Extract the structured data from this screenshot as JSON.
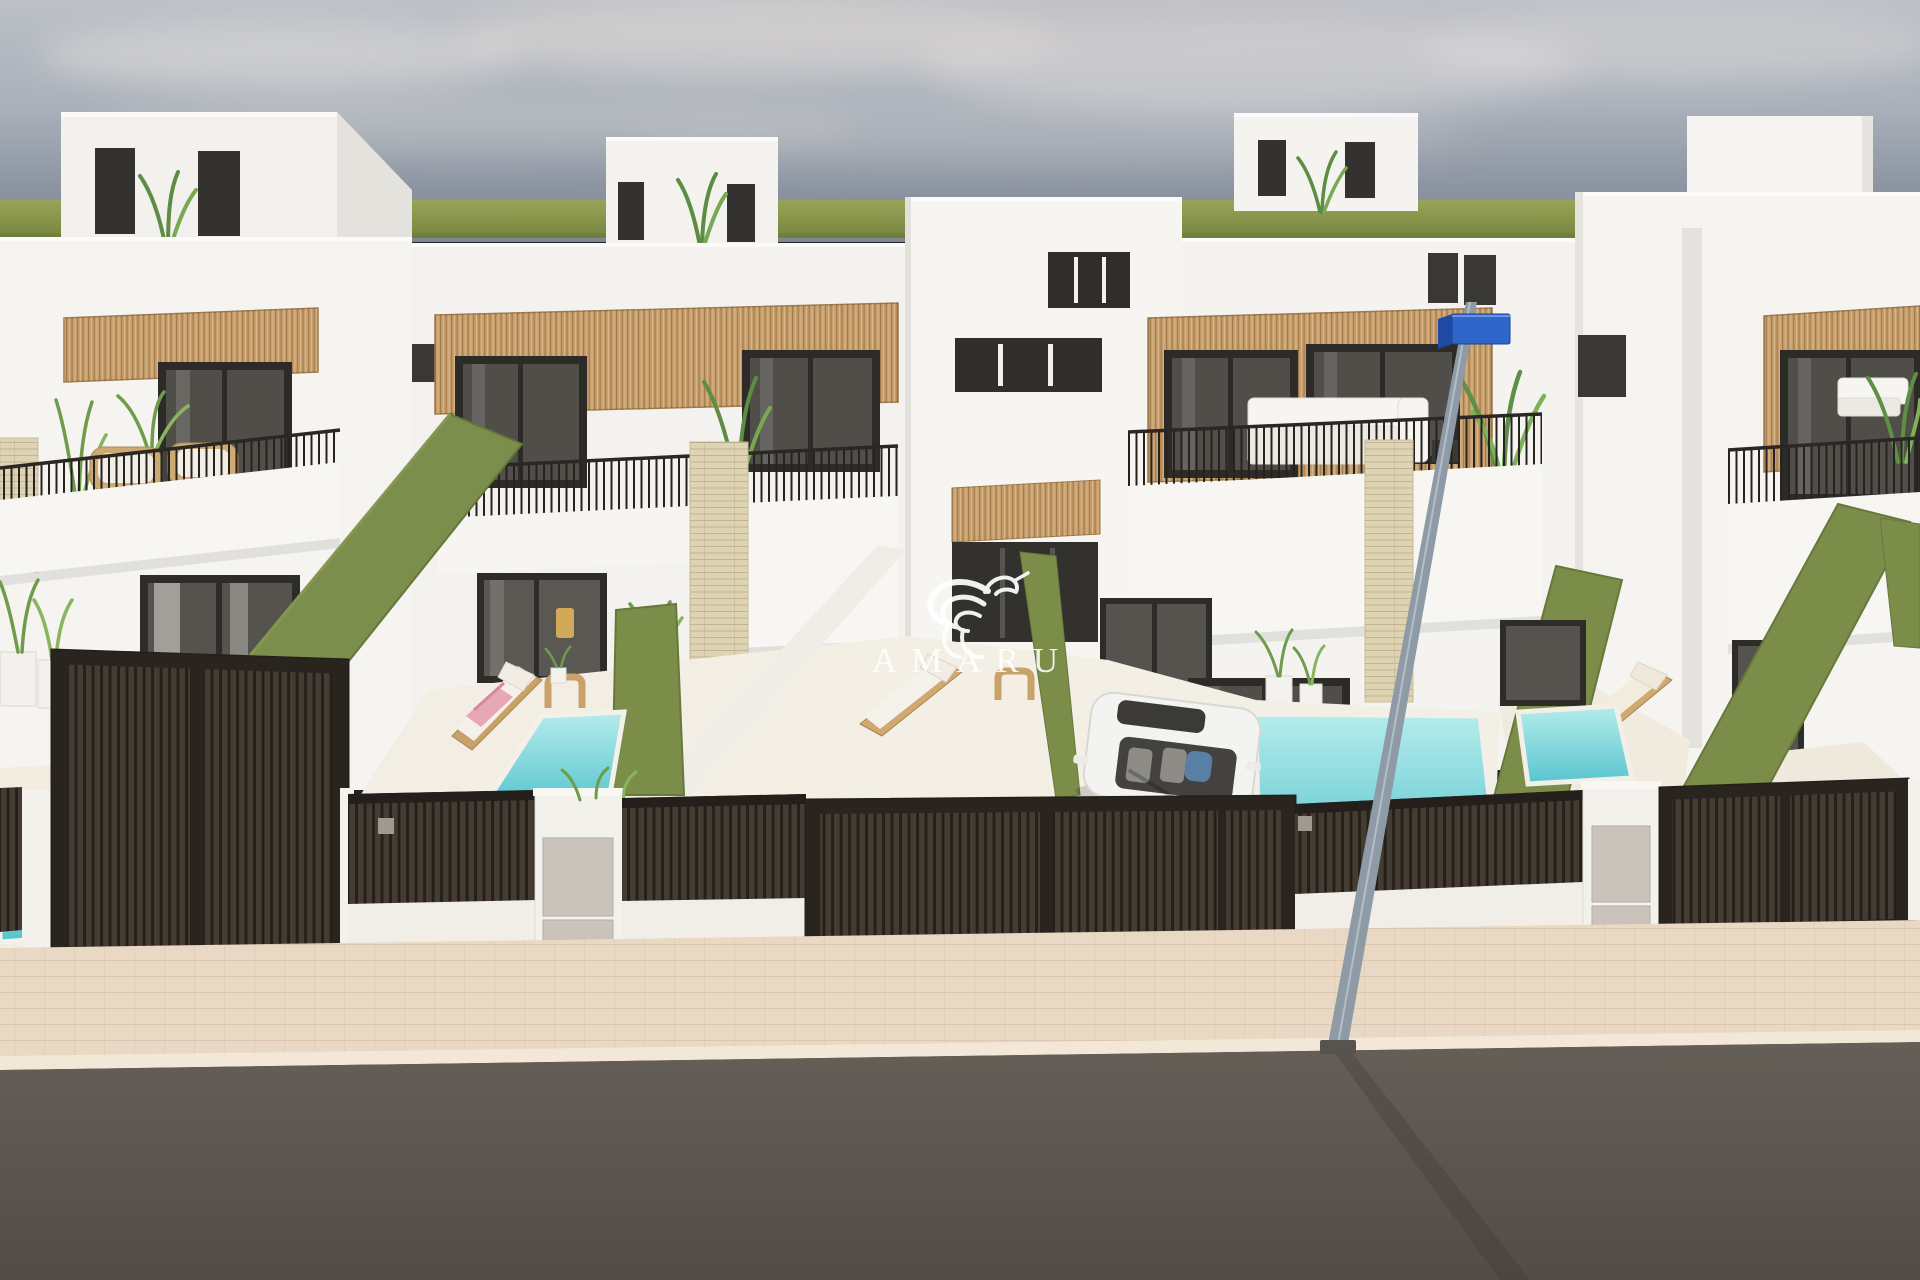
{
  "watermark": {
    "text": "AMARU",
    "logo": "hummingbird-flourish-logo"
  },
  "scene": {
    "type": "architectural-3d-render",
    "setting": "Street-front view of a row of modern white two-storey townhouses with roof terraces, private plunge pools and dark slatted gates",
    "objects": [
      "roof stair bulkheads with slit windows and plants",
      "cantilever parasol on roof terrace",
      "wood-slat facade panels",
      "dark framed glass doors and windows",
      "black vertical-bar balcony railings",
      "wicker balcony chairs",
      "white terrace sofas",
      "artificial green hedge dividing walls",
      "turquoise plunge pools",
      "sun loungers with pink towels",
      "wooden side tables",
      "white convertible car with driver in driveway",
      "dark brown slatted gates and fences",
      "white pillars with utility meter panels",
      "street lamp with blue sign",
      "paved beige sidewalk",
      "asphalt road"
    ]
  },
  "colors": {
    "sky_top": "#bcc0c7",
    "sky_horizon": "#7d8794",
    "grass": "#8a9750",
    "wall_white": "#f5f4f1",
    "wall_shade": "#e4e2dd",
    "wood_slat": "#c79e6b",
    "window_frame": "#2c2b28",
    "glass": "#514f4a",
    "railing": "#26231f",
    "hedge_green": "#7b8d49",
    "pool_light": "#b6ecec",
    "pool_deep": "#58c5cf",
    "patio": "#f3eee4",
    "fence_dark": "#362f28",
    "fence_wall": "#f1eee8",
    "meter_panel": "#c9c3bb",
    "stone_pillar": "#ded3b3",
    "sidewalk": "#e9d8c3",
    "road": "#5e5750",
    "sign_blue": "#2f66ca",
    "pole_grey": "#8e9ba7",
    "car_white": "#f3f3f1",
    "towel_pink": "#e8a7b4",
    "watermark": "#ffffff"
  }
}
